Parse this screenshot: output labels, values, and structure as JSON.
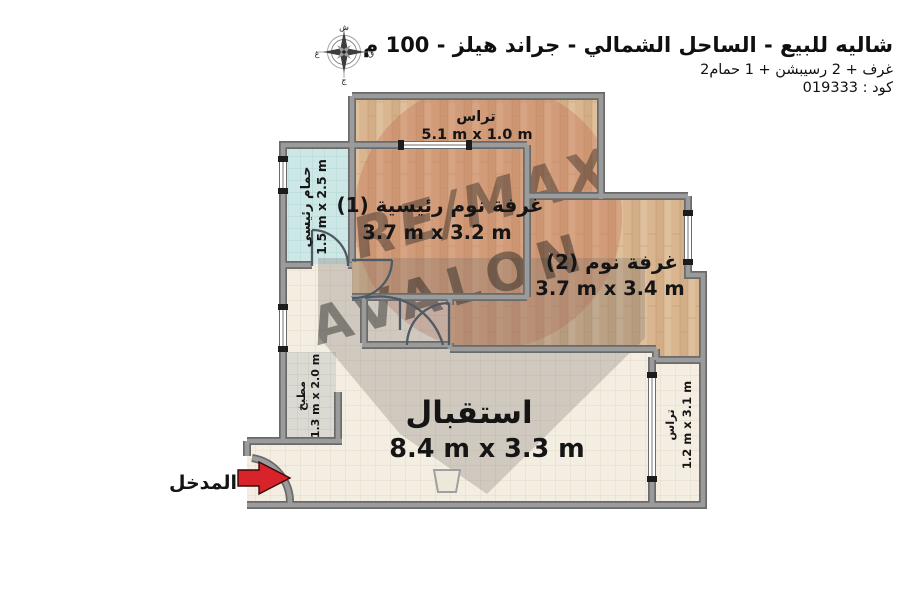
{
  "header": {
    "title": "شاليه للبيع - الساحل الشمالي - جراند هيلز - 100 م",
    "subtitle": "2غرف + 2 رسيبشن + 1 حمام",
    "code": "كود : 019333"
  },
  "compass": {
    "north": "ش",
    "south": "ج",
    "east": "ق",
    "west": "غ"
  },
  "rooms": {
    "terrace_top": {
      "name": "تراس",
      "dims": "5.1 m x 1.0 m"
    },
    "master_bedroom": {
      "name": "غرفة نوم رئيسية (1)",
      "dims": "3.7 m x 3.2 m"
    },
    "bedroom_2": {
      "name": "غرفة نوم (2)",
      "dims": "3.7 m x 3.4 m"
    },
    "bathroom": {
      "name": "حمام رئيسي",
      "dims": "1.5 m x 2.5 m"
    },
    "kitchen": {
      "name": "مطبخ",
      "dims": "1.3 m x 2.0 m"
    },
    "reception": {
      "name": "استقبال",
      "dims": "8.4 m x 3.3 m"
    },
    "terrace_side": {
      "name": "تراس",
      "dims": "1.2 m x 3.1 m"
    }
  },
  "entrance": {
    "label": "المدخل"
  },
  "watermark": {
    "brand": "RE/MAX",
    "name": "AVALON"
  },
  "colors": {
    "wall": "#9b9b9b",
    "wall_edge": "#6a6a6a",
    "wood": "#d9b590",
    "bathroom": "#cde7e7",
    "kitchen": "#dadad2",
    "floor": "#f4eee2",
    "accent_red": "#d8232a"
  }
}
